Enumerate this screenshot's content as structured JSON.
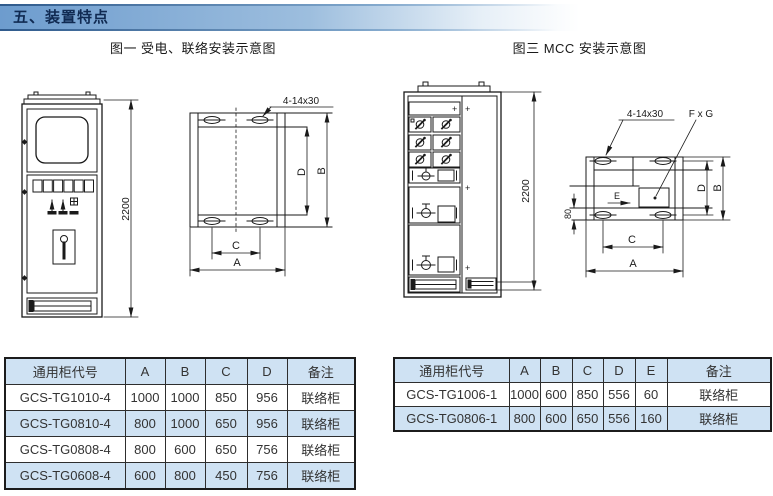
{
  "header": {
    "title": "五、装置特点"
  },
  "figure1": {
    "title": "图一 受电、联络安装示意图",
    "height_dim": "2200",
    "slot_label": "4-14x30",
    "dim_a": "A",
    "dim_b": "B",
    "dim_c": "C",
    "dim_d": "D"
  },
  "figure3": {
    "title": "图三 MCC 安装示意图",
    "height_dim": "2200",
    "slot_label": "4-14x30",
    "opening_label": "F x G",
    "entry_label": "E",
    "offset_dim": "80",
    "plus_mark": "+",
    "dim_a": "A",
    "dim_b": "B",
    "dim_c": "C",
    "dim_d": "D"
  },
  "table_fig1": {
    "headers": [
      "通用柜代号",
      "A",
      "B",
      "C",
      "D",
      "备注"
    ],
    "rows": [
      [
        "GCS-TG1010-4",
        "1000",
        "1000",
        "850",
        "956",
        "联络柜"
      ],
      [
        "GCS-TG0810-4",
        "800",
        "1000",
        "650",
        "956",
        "联络柜"
      ],
      [
        "GCS-TG0808-4",
        "800",
        "600",
        "650",
        "756",
        "联络柜"
      ],
      [
        "GCS-TG0608-4",
        "600",
        "800",
        "450",
        "756",
        "联络柜"
      ]
    ]
  },
  "table_fig3": {
    "headers": [
      "通用柜代号",
      "A",
      "B",
      "C",
      "D",
      "E",
      "备注"
    ],
    "rows": [
      [
        "GCS-TG1006-1",
        "1000",
        "600",
        "850",
        "556",
        "60",
        "联络柜"
      ],
      [
        "GCS-TG0806-1",
        "800",
        "600",
        "650",
        "556",
        "160",
        "联络柜"
      ]
    ]
  },
  "colors": {
    "accent_blue": "#6d9cce",
    "table_header_bg": "#cfe2f3",
    "line": "#1a1a1a"
  }
}
